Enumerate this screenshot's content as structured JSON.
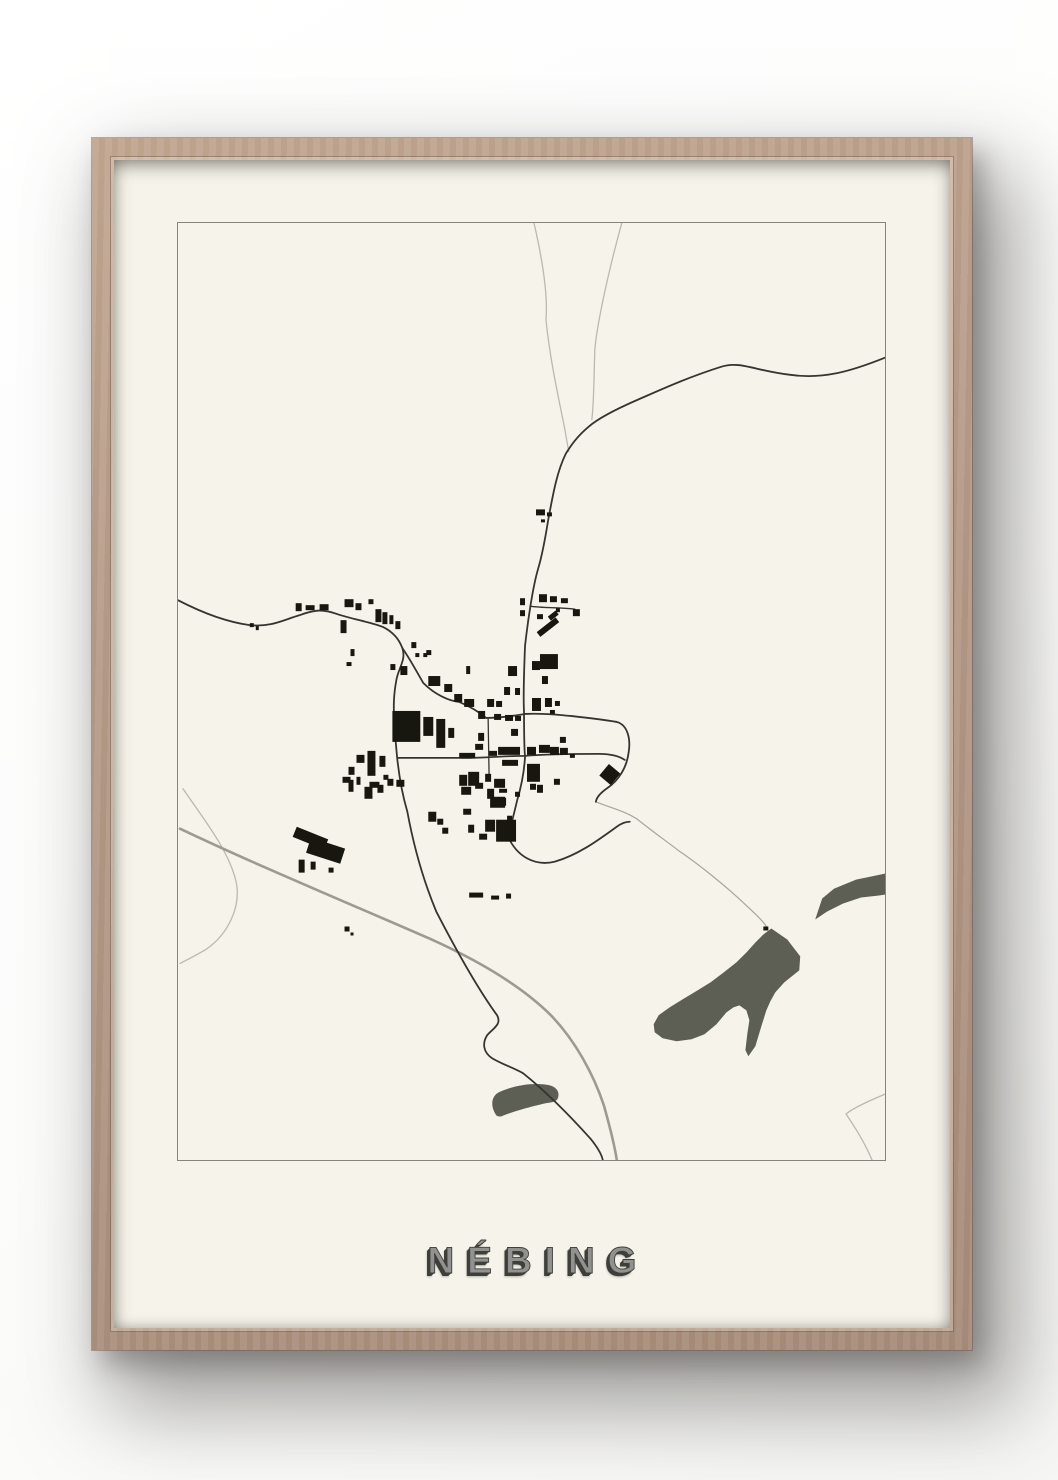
{
  "poster": {
    "title": "NÉBING"
  },
  "colors": {
    "page_bg": "#fcfcfb",
    "frame_wood": "#b49987",
    "frame_wood_light": "#c2a791",
    "frame_wood_dark": "#a78c7a",
    "poster_bg": "#f6f4ea",
    "map_border": "#85857e",
    "building": "#17170f",
    "road_dark": "#353430",
    "road_light": "#b9b9b0",
    "railway": "#9c9a91",
    "water": "#5d5f55",
    "title_fill": "#919190",
    "title_shadow": "#3f3f3a"
  }
}
